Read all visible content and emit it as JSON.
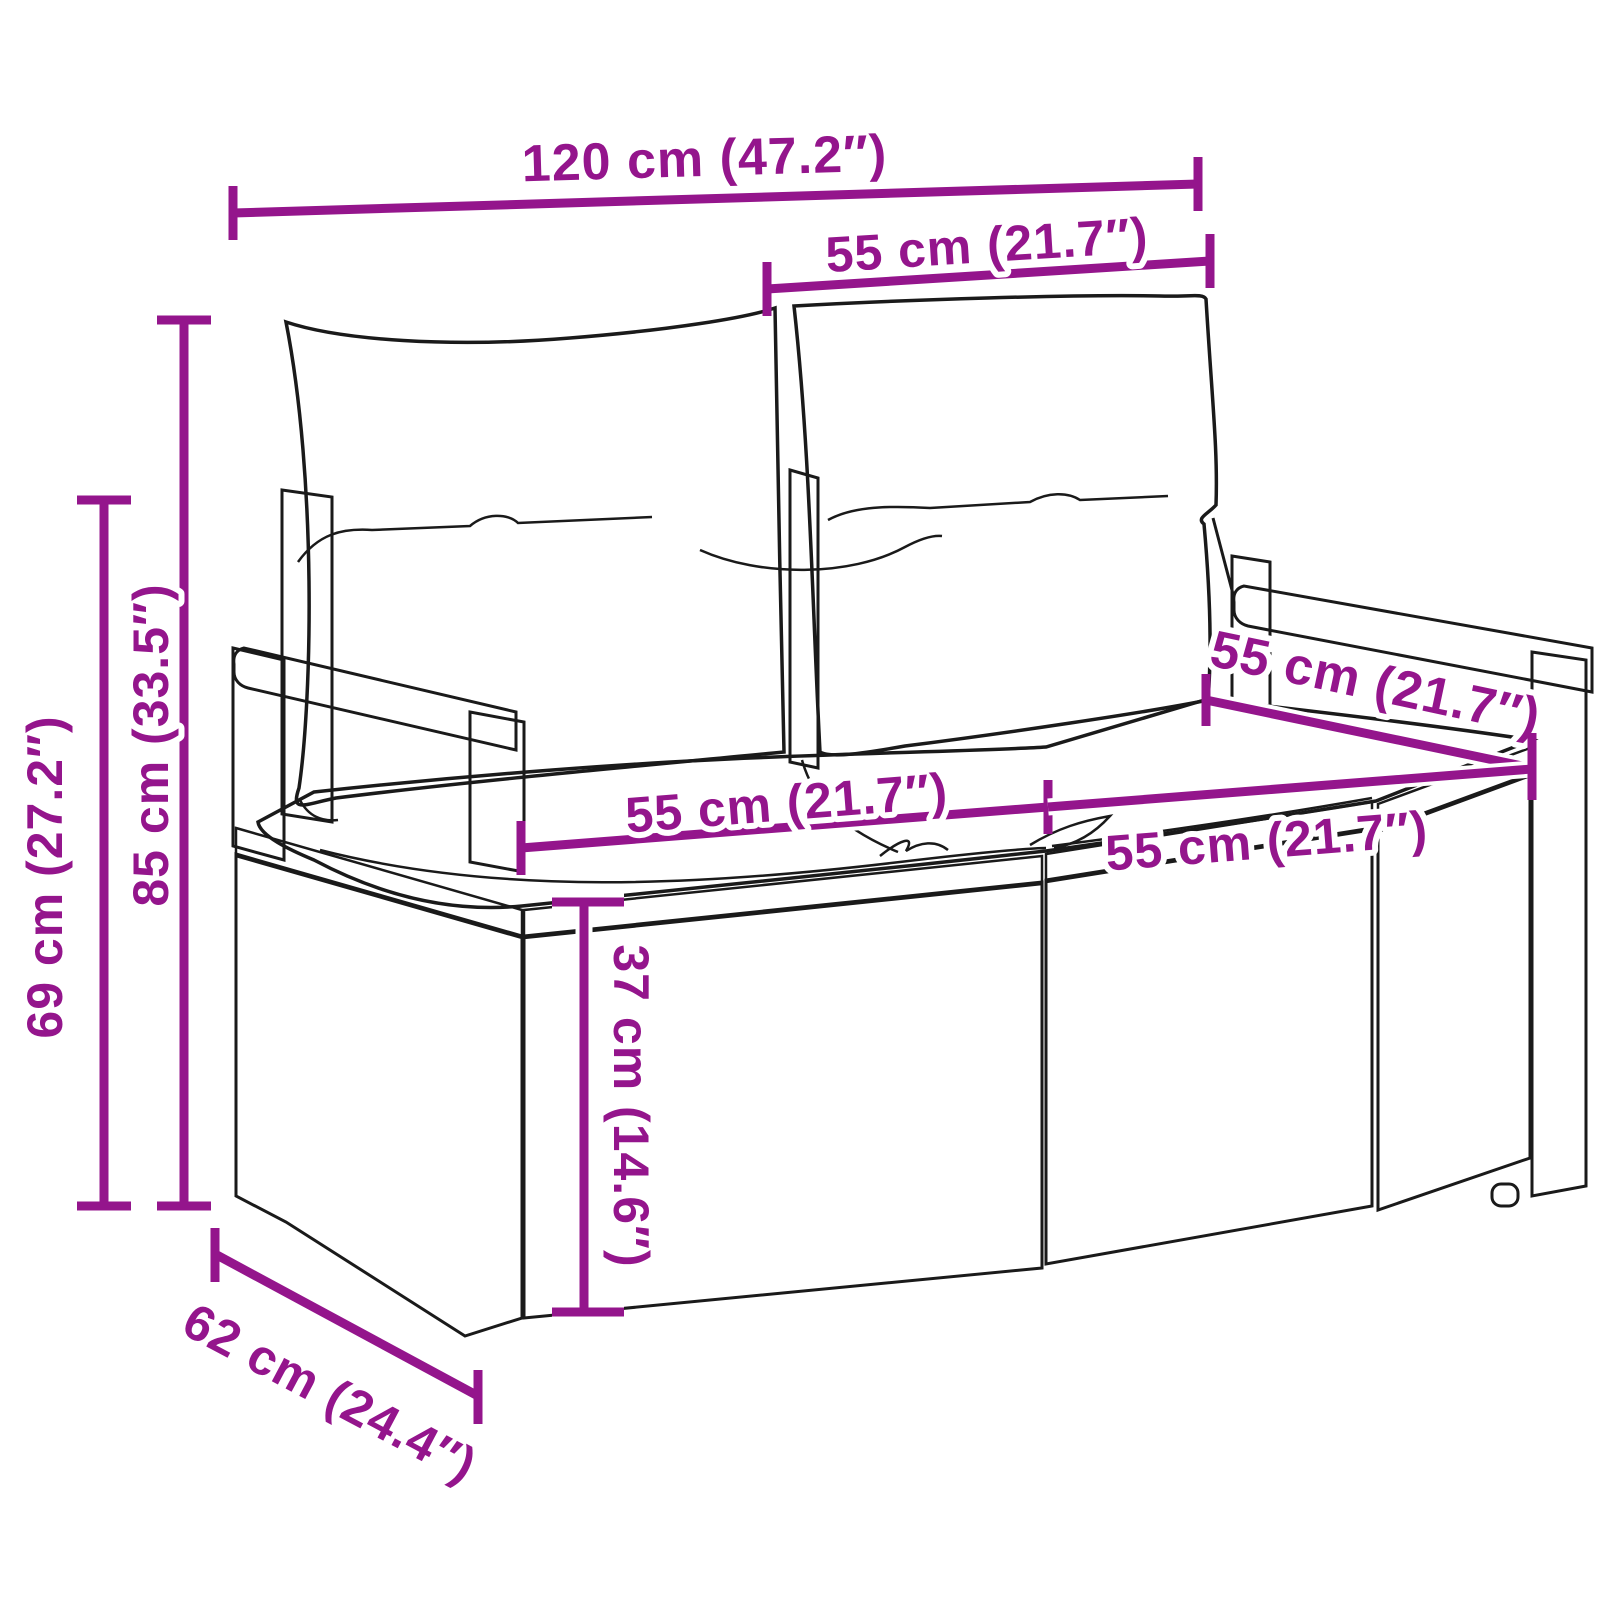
{
  "illustration": {
    "name": "poly-rattan-two-seater-garden-bench-with-cushions",
    "style": "black line-art product drawing"
  },
  "colors": {
    "accent": "#94158C",
    "line": "#1A1A1A",
    "background": "#FFFFFF"
  },
  "dims": {
    "overall_width": "120 cm (47.2″)",
    "back_cushion_width": "55 cm (21.7″)",
    "total_height": "85 cm (33.5″)",
    "frame_height": "69 cm (27.2″)",
    "seat_depth": "55 cm (21.7″)",
    "seat_width_left": "55 cm (21.7″)",
    "seat_width_right": "55 cm (21.7″)",
    "seat_height": "37 cm (14.6″)",
    "overall_depth": "62 cm (24.4″)"
  }
}
